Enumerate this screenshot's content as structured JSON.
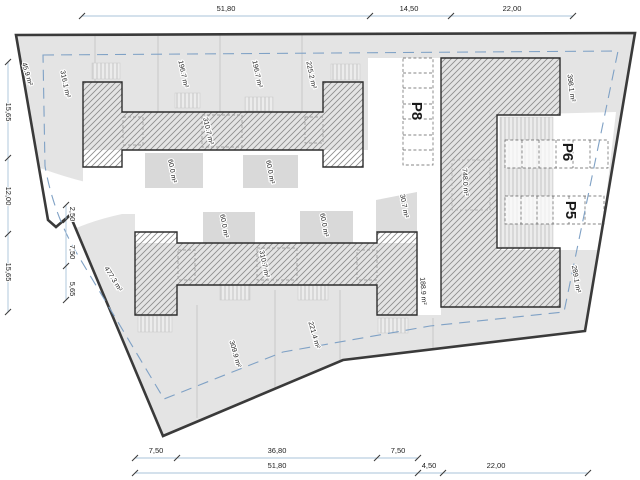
{
  "site": {
    "title": "residential site plan",
    "areas": {
      "sliver": "45.9 m²",
      "plot_nw": "316.1 m²",
      "plot_n1": "196.7 m²",
      "plot_n2": "196.7 m²",
      "plot_n3": "225.2 m²",
      "plot_ne": "398.1 m²",
      "building_top": "310.7 m²",
      "building_bottom": "310.7 m²",
      "terrace_top_a": "60.0 m²",
      "terrace_top_b": "60.0 m²",
      "terrace_bot_a": "60.0 m²",
      "terrace_bot_b": "60.0 m²",
      "corner_garden": "30.7 m²",
      "building_right": "748.0 m²",
      "plot_e": "188.9 m²",
      "plot_se": "289.1 m²",
      "plot_sw": "477.3 m²",
      "plot_s1": "309.9 m²",
      "plot_s2": "221.4 m²"
    },
    "parking": {
      "p8": "P8",
      "p6": "P6",
      "p5": "P5"
    },
    "dims": {
      "top": [
        "51,80",
        "14,50",
        "22,00"
      ],
      "left_outer": [
        "15,65",
        "12,00",
        "15,65"
      ],
      "left_inner": [
        "2,50",
        "7,50",
        "5,65"
      ],
      "bottom_inner": [
        "7,50",
        "36,80",
        "7,50"
      ],
      "bottom_outer": [
        "51,80",
        "4,50",
        "22,00"
      ]
    },
    "colors": {
      "parcel_fill": "#e4e4e4",
      "boundary": "#3a3a3a",
      "garden_fill": "#d9d9d9",
      "setback_line": "#7fa1c5",
      "dimension_line": "#aac3da"
    }
  }
}
